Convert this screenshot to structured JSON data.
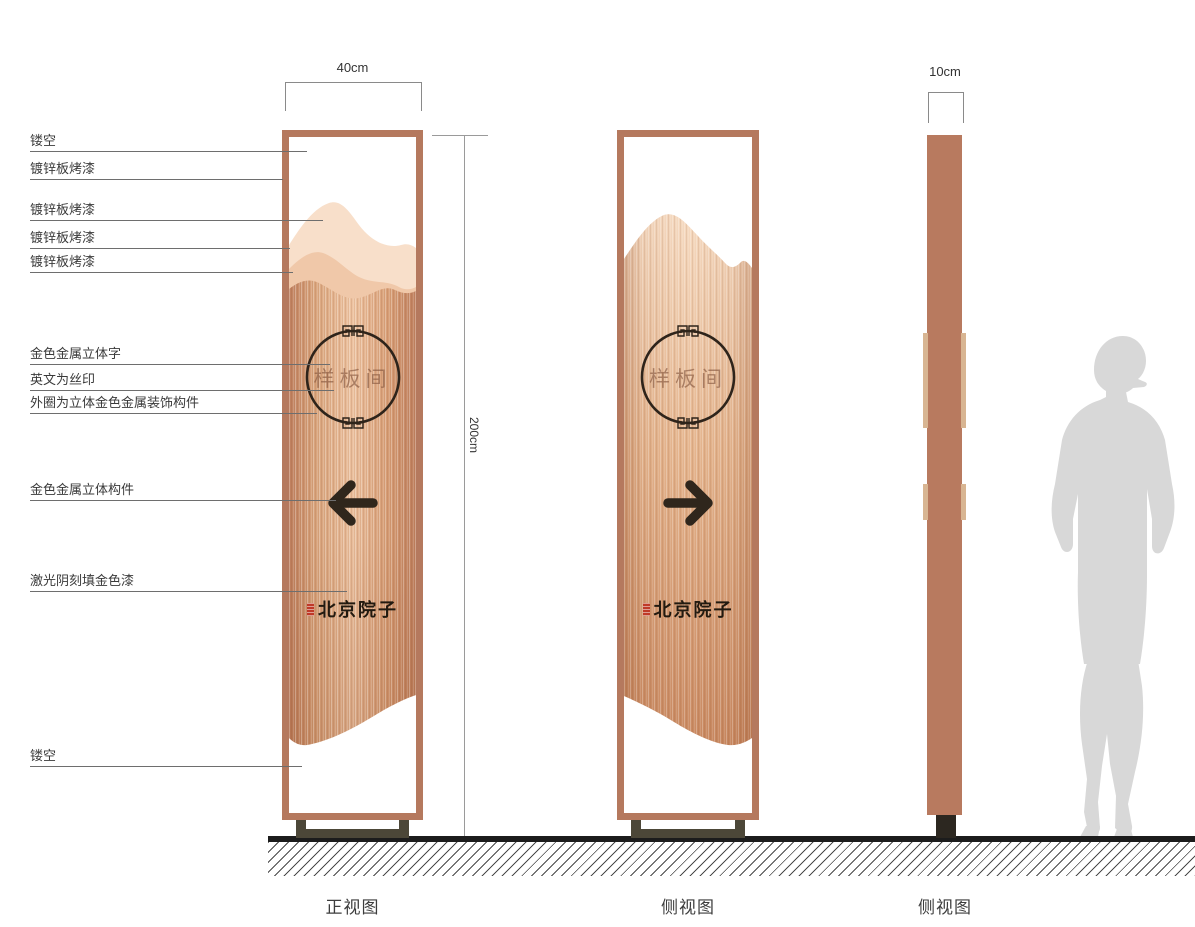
{
  "annotations": {
    "labels": [
      {
        "text": "镂空"
      },
      {
        "text": "镀锌板烤漆"
      },
      {
        "text": "镀锌板烤漆"
      },
      {
        "text": "镀锌板烤漆"
      },
      {
        "text": "镀锌板烤漆"
      },
      {
        "text": "金色金属立体字"
      },
      {
        "text": "英文为丝印"
      },
      {
        "text": "外圈为立体金色金属装饰构件"
      },
      {
        "text": "金色金属立体构件"
      },
      {
        "text": "激光阴刻填金色漆"
      },
      {
        "text": "镂空"
      }
    ]
  },
  "dimensions": {
    "front_width": "40cm",
    "height": "200cm",
    "side_width": "10cm"
  },
  "sign": {
    "room_label": "样板间",
    "brand": "北京院子"
  },
  "captions": {
    "front": "正视图",
    "side1": "侧视图",
    "side2": "侧视图"
  },
  "icons": {
    "front_arrow": "left-arrow",
    "back_arrow": "right-arrow",
    "circle_ornament": "chinese-fret-circle",
    "seal": "red-seal-stamp"
  },
  "colors": {
    "frame_copper": "#b5795e",
    "panel_center": "#eec4a2",
    "mountain_light": "#f8dfca",
    "mountain_mid": "#f0c8a9",
    "ink_dark": "#2e241b",
    "seal_red": "#bf3a28",
    "base_olive": "#4c4738",
    "ground_black": "#1c1c1c",
    "figure_gray": "#d8d8d8"
  }
}
